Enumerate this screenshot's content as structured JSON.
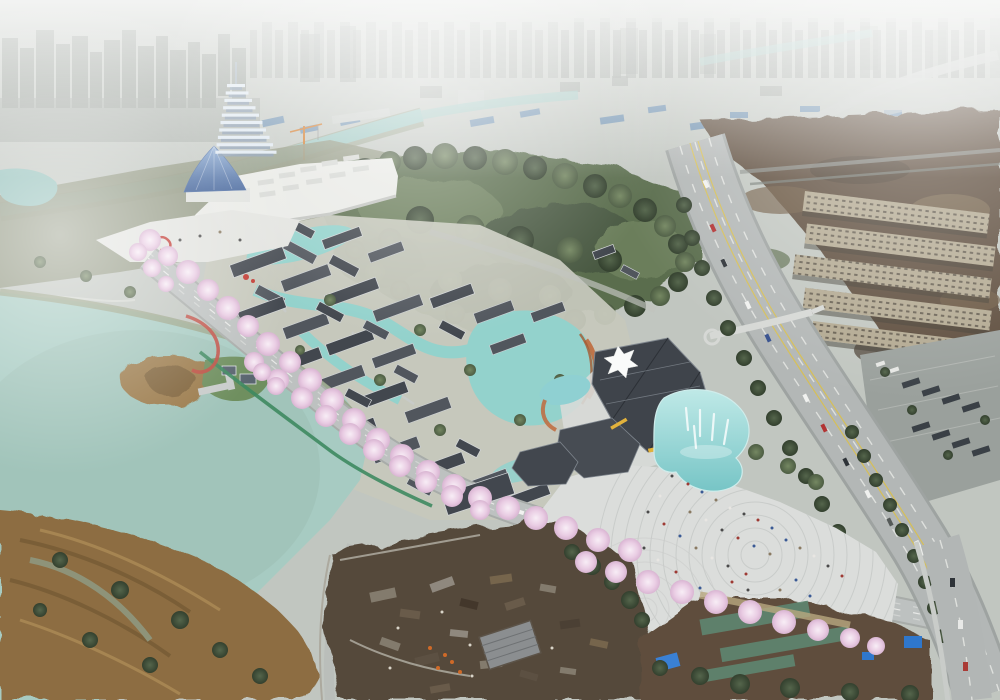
{
  "image": {
    "kind": "aerial architectural rendering of a riverside cultural-park masterplan",
    "width_px": 1000,
    "height_px": 700,
    "season": "spring, cherry trees in bloom",
    "atmosphere": "hazy smoggy city background, clear rendered foreground"
  },
  "palette": {
    "sky": "#c1c6c0",
    "hazeWhite": "#ffffff",
    "cityFar": "#8d948e",
    "industrialBlue": "#5d85ac",
    "riverWater": "#9cc6c0",
    "riverBank": "#7e8c6d",
    "forest": "#5a6d4e",
    "forestDark": "#455440",
    "lawn": "#8f957e",
    "lake": "#a7cbc2",
    "reeds": "#8d6d42",
    "villageWater": "#93d2cc",
    "terracotta": "#bf6a3c",
    "roofDark": "#42474e",
    "roofLight": "#51565d",
    "boulevardAsphalt": "#bdc1c0",
    "highwayAsphalt": "#b3b7b6",
    "laneYellow": "#d9c04c",
    "blossomPink": "#e9cce3",
    "blossomLight": "#f8eef6",
    "plazaPaving": "#dbdddb",
    "poolWater": "#8fd0d2",
    "expoWhite": "#e9eae6",
    "tentBlue": "#4e6fa6",
    "pagodaWhite": "#dde7f0",
    "apartmentBeige": "#b2a890",
    "brownfield": "#5b4b3b",
    "demolitionGround": "#55483b",
    "parkingGray": "#9aa09c",
    "greenTrail": "#3e8a60",
    "redAccent": "#c23a32",
    "netting": "#5e8a74",
    "tarpBlue": "#2f77cc",
    "craneOrange": "#d07828",
    "treeGreen": "#6f8260",
    "treeDark": "#55664c"
  },
  "regions": {
    "background": [
      "city-skyline",
      "industrial-belt",
      "city-river",
      "elevated-road",
      "construction-crane"
    ],
    "landmarks": [
      "pagoda-tower",
      "expo-center",
      "tent-pavilion",
      "forecourt-plaza",
      "red-sculpture"
    ],
    "park": [
      "central-forest",
      "traditional-village",
      "village-canals",
      "cherry-blossom-boulevard",
      "green-trail",
      "red-trail",
      "visitor-center",
      "fountain-pool",
      "festival-plaza",
      "shade-canopy",
      "crowds"
    ],
    "water": [
      "lake",
      "wetland-reeds",
      "reed-island",
      "boat-dock",
      "lake-pavilions"
    ],
    "east": [
      "arterial-highway",
      "pedestrian-overpass",
      "apartment-blocks",
      "parking-lot",
      "brownfield"
    ],
    "south": [
      "demolition-site",
      "brick-house",
      "farm-fields",
      "greenhouse-netting",
      "tarp-sheds",
      "riverside-road"
    ]
  },
  "counts": {
    "pagoda_tiers": 10,
    "apartment_slabs": 5,
    "fountain_jets": 5
  }
}
